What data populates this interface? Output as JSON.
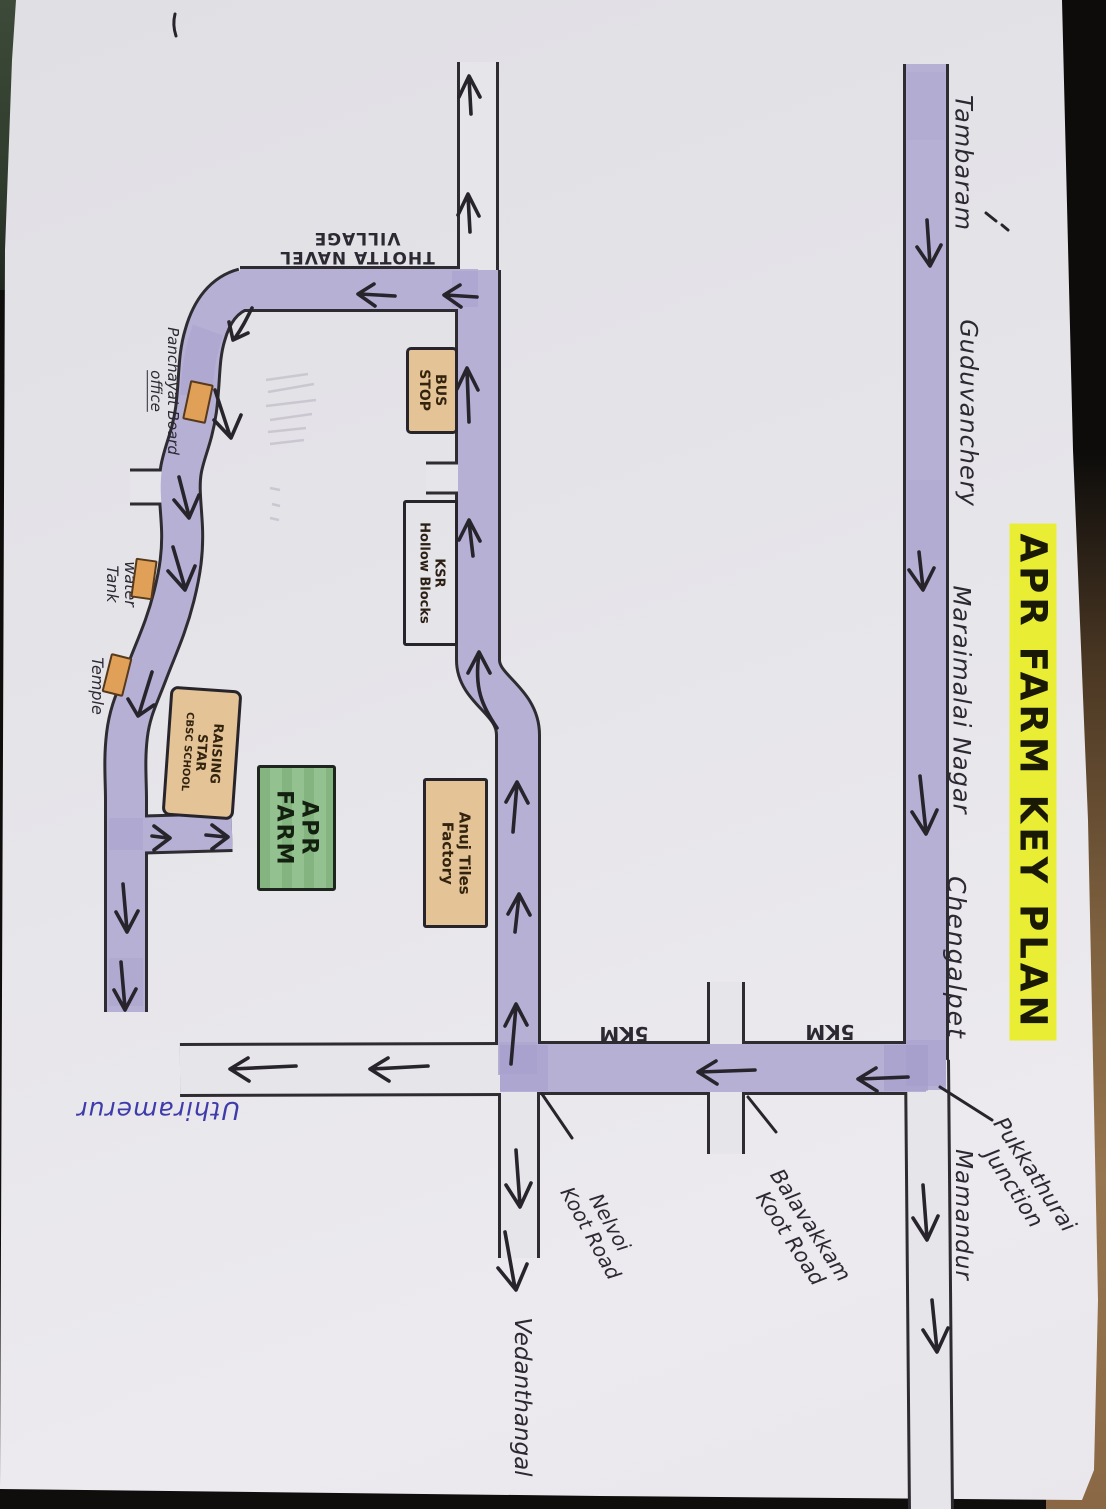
{
  "title": "APR FARM KEY PLAN",
  "places": {
    "tambaram": "Tambaram",
    "guduvanchery": "Guduvanchery",
    "maraimalai_nagar": "Maraimalai Nagar",
    "chengalpet": "Chengalpet",
    "mamandur": "Mamandur",
    "uthiramerur": "Uthiramerur",
    "vedanthangal": "Vedanthangal",
    "thotta_navel": {
      "line1": "THOTTA NAVEL",
      "line2": "VILLAGE"
    }
  },
  "junctions": {
    "pukkathurai": {
      "line1": "Pukkathurai",
      "line2": "Junction"
    },
    "balavakkam": {
      "line1": "Balavakkam",
      "line2": "Koot Road"
    },
    "nelvoi": {
      "line1": "Nelvoi",
      "line2": "Koot Road"
    }
  },
  "distances": {
    "km_left": "5KM",
    "km_right": "5KM"
  },
  "landmarks": {
    "panchayat": {
      "line1": "Panchayat Board",
      "line2": "office"
    },
    "water_tank": {
      "line1": "water",
      "line2": "Tank"
    },
    "temple": "Temple",
    "bus_stop": {
      "line1": "BUS",
      "line2": "STOP"
    },
    "ksr": {
      "line1": "KSR",
      "line2": "Hollow Blocks"
    },
    "anuj": {
      "line1": "Anuj Tiles",
      "line2": "Factory"
    },
    "school": {
      "line1": "RAISING",
      "line2": "STAR",
      "line3": "CBSC SCHOOL"
    },
    "apr_farm": {
      "line1": "APR",
      "line2": "FARM"
    }
  },
  "colors": {
    "road_fill": "#b6b0d5",
    "road_shade": "#a29bcb",
    "ink": "#2c2933",
    "highlight_yellow": "#e9ee35",
    "tan_box": "#e4c396",
    "green_box": "#8aba88",
    "orange_marker": "#e0a058",
    "blue_ink": "#3e3caa",
    "paper": "#e6e5ea"
  }
}
